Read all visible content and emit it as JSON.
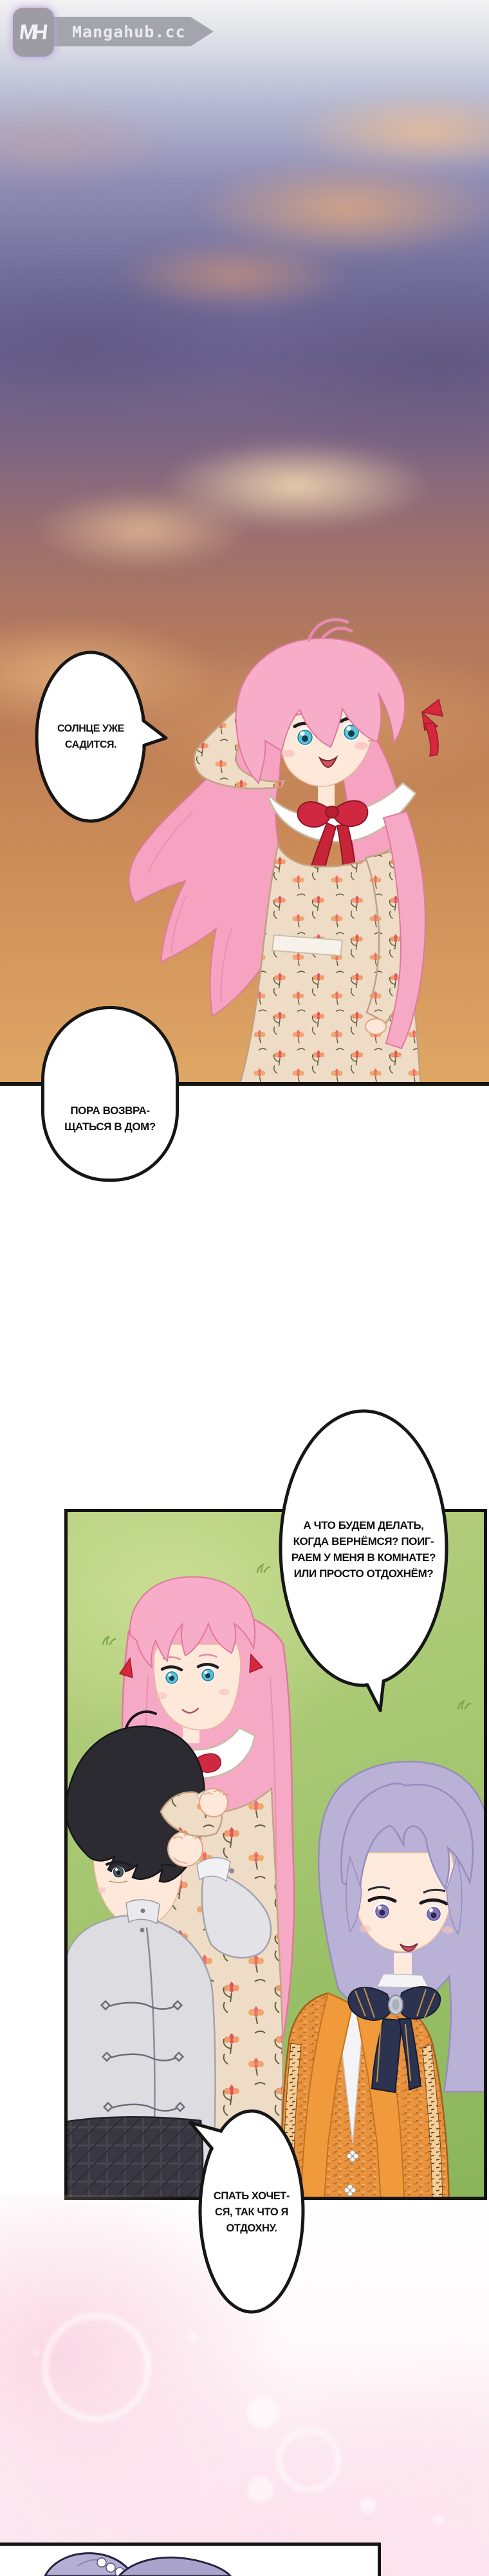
{
  "watermark": {
    "monogram": "MH",
    "site": "Mangahub.cc"
  },
  "bubbles": {
    "b1": {
      "speaker": "pink-haired-girl",
      "text": "СОЛНЦЕ УЖЕ\nСАДИТСЯ."
    },
    "b2": {
      "speaker": "pink-haired-girl",
      "text": "ПОРА ВОЗВРА-\nЩАТЬСЯ В ДОМ?"
    },
    "b3": {
      "speaker": "pink-haired-girl",
      "text": "А ЧТО БУДЕМ ДЕЛАТЬ,\nКОГДА ВЕРНЁМСЯ? ПОИГ-\nРАЕМ У МЕНЯ В КОМНАТЕ?\nИЛИ ПРОСТО ОТДОХНЁМ?"
    },
    "b4": {
      "speaker": "purple-haired-child",
      "text": "СПАТЬ ХОЧЕТ-\nСЯ, ТАК ЧТО Я\nОТДОХНУ."
    }
  },
  "colors": {
    "panel_border": "#15130f",
    "bubble_fill": "#ffffff",
    "bubble_stroke": "#161616",
    "grass": "#a8c873",
    "sky_dusk_purple": "#6b6290",
    "sky_orange": "#c98756",
    "hair_pink": "#f6a9c4",
    "hair_black": "#2b2b31",
    "hair_purple": "#b9b1d6",
    "bow_red": "#cf2840",
    "vest_orange": "#ea9440",
    "glow_pink": "#fae4ed",
    "logo_gray": "#9c9ca2"
  }
}
